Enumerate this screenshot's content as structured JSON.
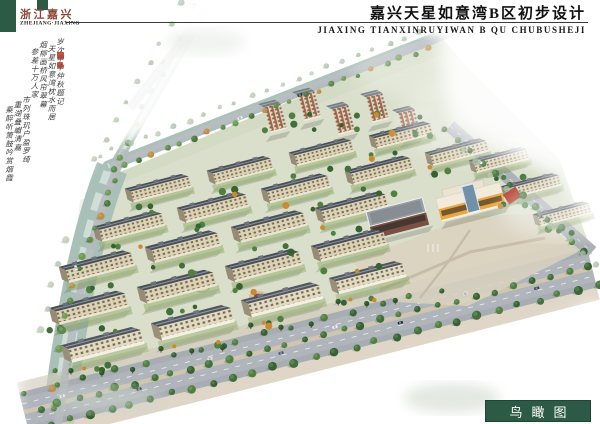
{
  "header": {
    "stamp_cn": "浙江嘉兴",
    "stamp_en": "ZHEJIANG·JIAXING",
    "title_cn": "嘉兴天星如意湾B区初步设计",
    "title_en": "JIAXING TIANXINRUYIWAN B QU CHUBUSHEJI"
  },
  "calligraphy": {
    "columns": [
      "岁次甲申仲秋题记",
      "天星如意湾枕水而居",
      "烟柳画桥风帘翠幕",
      "参差十万人家",
      "市列珠玑户盈罗绮",
      "重湖叠巘清嘉",
      "乘醉听箫鼓吟赏烟霞"
    ]
  },
  "footer": {
    "view_label": "鸟瞰图"
  },
  "colors": {
    "brand_green": "#2d5a44",
    "stamp_red": "#8a4434",
    "seal_red": "#b5392b",
    "roof_slate": "#4a5057",
    "facade_cream": "#ddd2b4",
    "kindergarten_yellow": "#eda53c",
    "water": "#a9c0b9",
    "road_gray": "#a8adb3"
  }
}
